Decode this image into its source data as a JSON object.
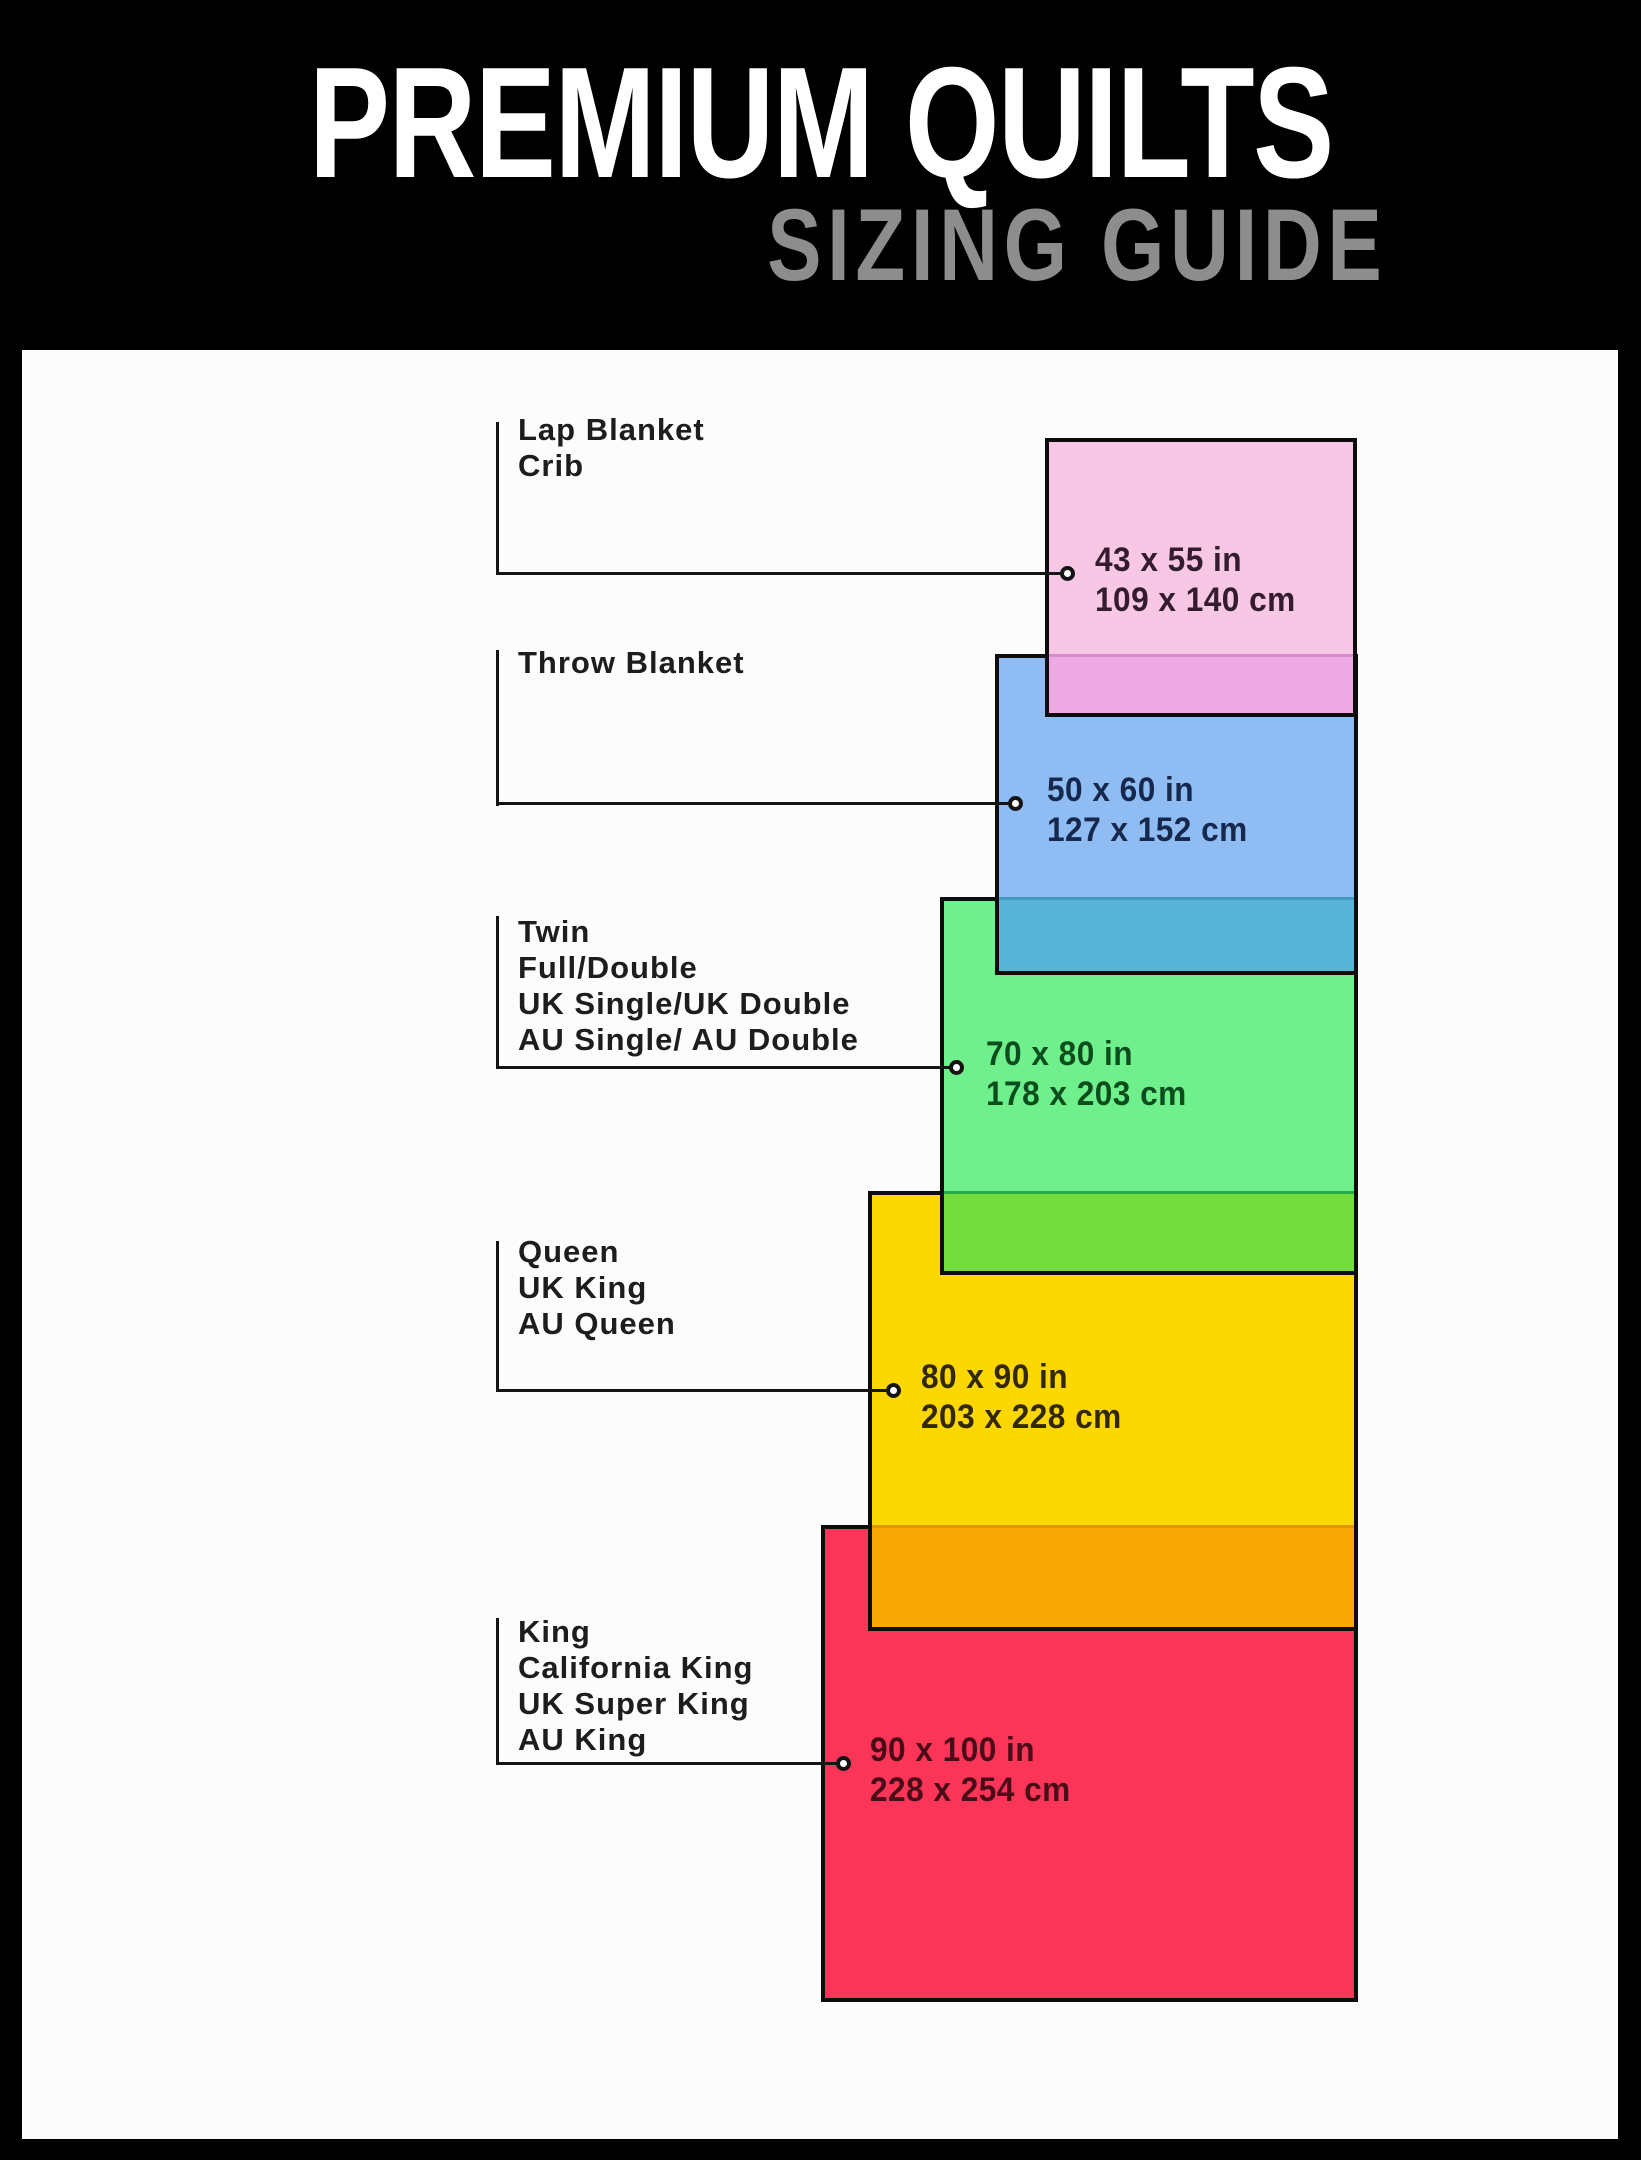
{
  "header": {
    "title": "PREMIUM QUILTS",
    "subtitle": "SIZING GUIDE",
    "title_color": "#ffffff",
    "subtitle_color": "#8d8d8d",
    "bg": "#000000"
  },
  "panel": {
    "bg": "#fcfcfc"
  },
  "leader": {
    "line_color": "#141414",
    "dot_fill": "#ffffff",
    "dot_ring": "#141414"
  },
  "items": [
    {
      "id": "lap-crib",
      "labels": [
        "Lap Blanket",
        "Crib"
      ],
      "size_in": "43 x 55 in",
      "size_cm": "109 x 140 cm",
      "fill": "#f8c7e5",
      "border": "#0d0d0d",
      "overlap_fill": "#eda9e2",
      "overlap_line": "#d78ccd",
      "text_color": "#321c2e"
    },
    {
      "id": "throw-blanket",
      "labels": [
        "Throw Blanket"
      ],
      "size_in": "50 x 60 in",
      "size_cm": "127 x 152 cm",
      "fill": "#8fbdf3",
      "border": "#0d0d0d",
      "overlap_fill": "#58b5d8",
      "overlap_line": "#3f9dc2",
      "text_color": "#16294d"
    },
    {
      "id": "twin-full-double",
      "labels": [
        "Twin",
        "Full/Double",
        "UK Single/UK Double",
        "AU Single/ AU Double"
      ],
      "size_in": "70 x 80 in",
      "size_cm": "178 x 203 cm",
      "fill": "#6ff08c",
      "border": "#0d0d0d",
      "overlap_fill": "#74dd3d",
      "overlap_line": "#21ad41",
      "text_color": "#0b4d1d"
    },
    {
      "id": "queen",
      "labels": [
        "Queen",
        "UK King",
        "AU Queen"
      ],
      "size_in": "80 x 90 in",
      "size_cm": "203 x 228 cm",
      "fill": "#fdd702",
      "border": "#0d0d0d",
      "overlap_fill": "#f8a703",
      "overlap_line": "#e09600",
      "text_color": "#322801"
    },
    {
      "id": "king",
      "labels": [
        "King",
        "California King",
        "UK Super King",
        "AU King"
      ],
      "size_in": "90 x 100 in",
      "size_cm": "228 x 254 cm",
      "fill": "#fb3557",
      "border": "#0d0d0d",
      "text_color": "#4a0c18"
    }
  ]
}
